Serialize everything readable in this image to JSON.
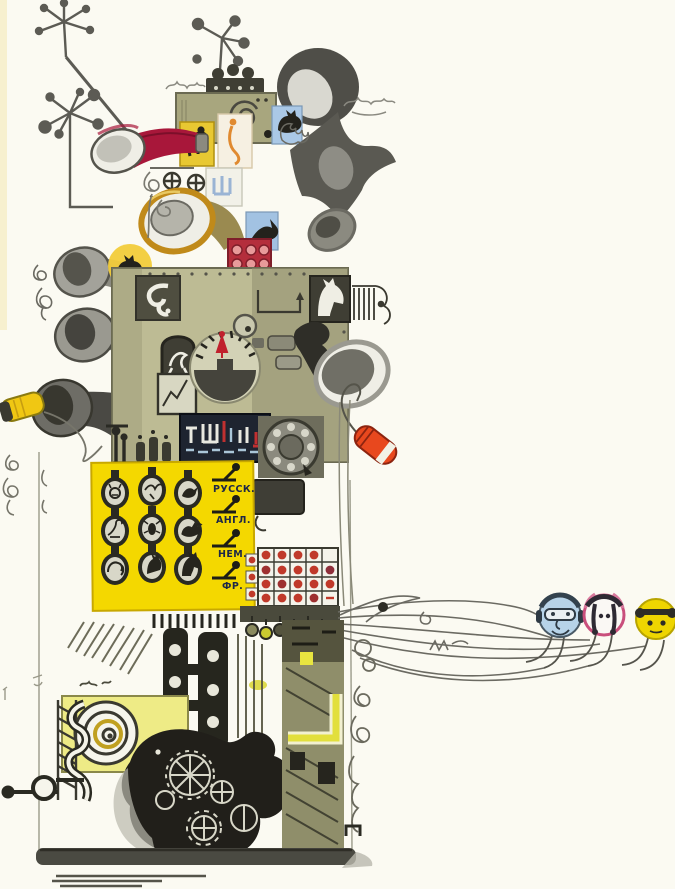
{
  "artwork": {
    "title": "Fantastic translation machine — book illustration",
    "style": "hand-drawn ink and watercolor",
    "language_panel": {
      "switches": [
        {
          "label": "РУССК."
        },
        {
          "label": "АНГЛ."
        },
        {
          "label": "НЕМ."
        },
        {
          "label": "ФР."
        }
      ]
    },
    "keyboard_animals": [
      "cat",
      "flying-bird",
      "bird",
      "goose",
      "beetle",
      "rooster",
      "elephant",
      "donkey",
      "horse"
    ],
    "listeners": [
      {
        "name": "listener-blue",
        "color": "#b7d3e8"
      },
      {
        "name": "listener-pink",
        "color": "#d4578a"
      },
      {
        "name": "listener-yellow",
        "color": "#eed501"
      }
    ],
    "palette": {
      "background": "#fbfaf2",
      "machine_olive": "#bdbb94",
      "ink": "#2e2d26",
      "panel_yellow": "#f4d800",
      "trumpet_red": "#a8173a",
      "microphone_orange": "#e8481e",
      "punch_dot_red": "#c0392a",
      "block_crimson": "#b42e3c",
      "block_blue": "#aac8e6",
      "horn_gold": "#c08a1a",
      "mic_yellow": "#f0c713"
    }
  }
}
